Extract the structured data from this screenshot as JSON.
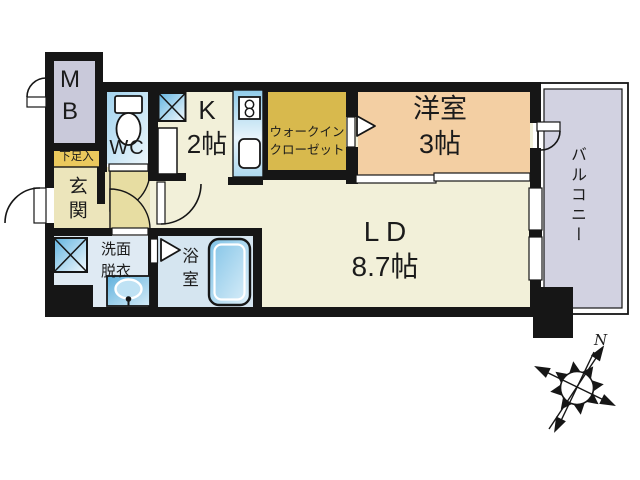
{
  "plan": {
    "title": "apartment-floor-plan",
    "rooms": {
      "mb": {
        "label": "M\nB"
      },
      "wc": {
        "label": "WC"
      },
      "kitchen": {
        "label": "K\n2帖"
      },
      "walk_in_closet": {
        "label": "ウォークイン\nクローゼット"
      },
      "western_room": {
        "label": "洋室\n3帖"
      },
      "living_dining": {
        "label": "L D\n8.7帖"
      },
      "balcony": {
        "label": "バルコニー"
      },
      "entrance": {
        "label": "玄関"
      },
      "shoe_box": {
        "label": "下足入"
      },
      "washroom": {
        "label": "洗面\n脱衣"
      },
      "bathroom": {
        "label": "浴室"
      }
    },
    "compass": {
      "north_label": "N"
    },
    "icons": [
      "toilet-icon",
      "stove-icon",
      "sink-icon",
      "refrigerator-space-icon",
      "washer-space-icon",
      "bathtub-icon",
      "basin-icon",
      "door-arc-icon",
      "folding-door-icon",
      "sliding-door-icon",
      "window-icon",
      "compass-rose-icon"
    ],
    "colors": {
      "wall_black": "#161616",
      "floor_cream": "#f2f0d9",
      "genkan_beige": "#ece5bb",
      "door_tan": "#e7dda2",
      "wic_gold": "#d8b94d",
      "western_peach": "#f3cfa3",
      "mb_gray": "#c9c9da",
      "balcony_gray": "#d2d2e1",
      "washroom_blue": "#dfeaf3",
      "bathroom_blue": "#d5e5f0",
      "shoe_yellow": "#ebc95d"
    }
  }
}
